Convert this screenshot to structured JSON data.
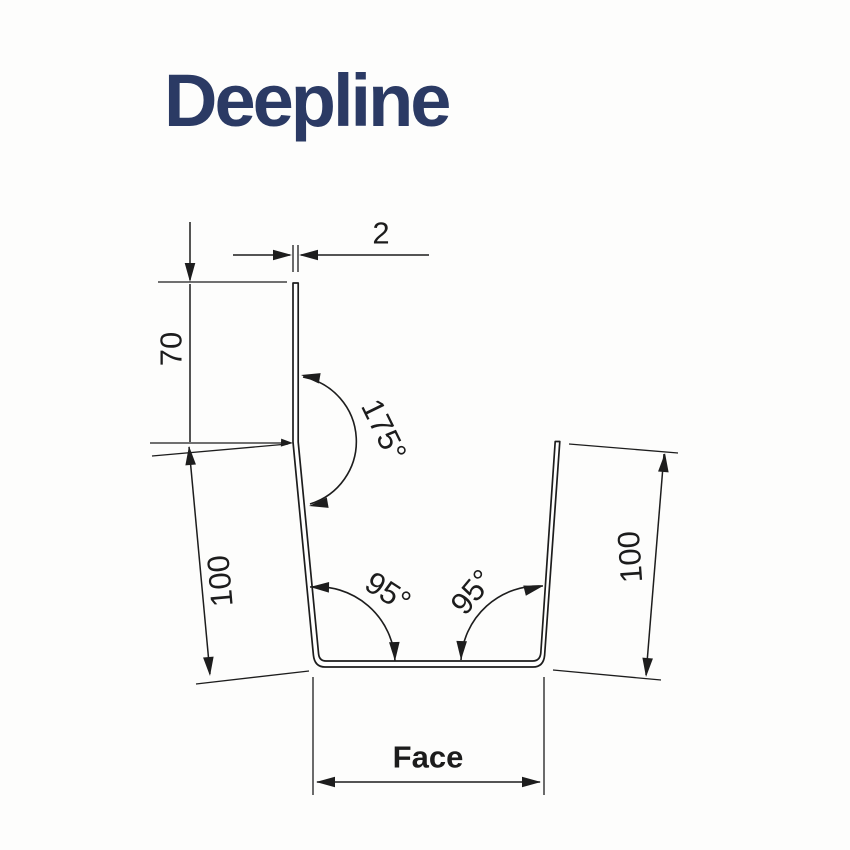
{
  "title": "Deepline",
  "colors": {
    "title_text": "#2b3a64",
    "line": "#1d1d1d",
    "background": "#fdfdfc"
  },
  "dims": {
    "thickness": "2",
    "upper_height": "70",
    "left_side": "100",
    "right_side": "100",
    "top_angle": "175°",
    "bottom_left_angle": "95°",
    "bottom_right_angle": "95°",
    "face": "Face"
  }
}
